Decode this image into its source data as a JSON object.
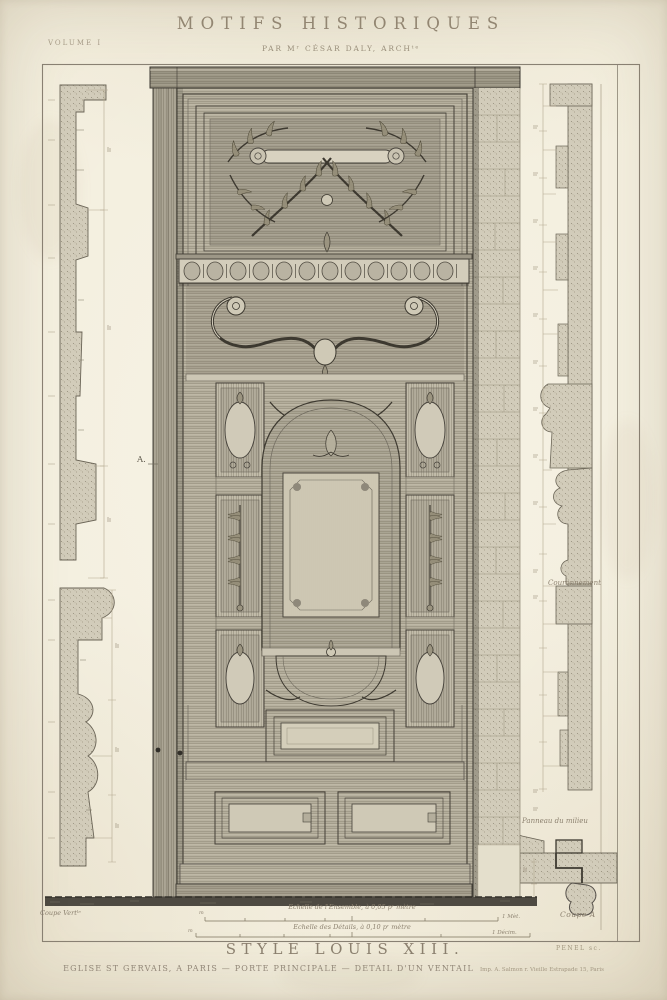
{
  "colors": {
    "paper": "#f3eedd",
    "ink": "#3e3a31",
    "faded_text": "#8d8270",
    "title_text": "#958976",
    "section_fill": "#d2ccba"
  },
  "header": {
    "volume": "VOLUME I",
    "title": "MOTIFS HISTORIQUES",
    "byline": "PAR Mʳ CÉSAR DALY, ARCHᵗᵉ"
  },
  "plate": {
    "marker_a": "A.",
    "label_couronnement": "Couronnement",
    "label_panneau": "Panneau du milieu",
    "label_coupe_verticale": "Coupe Vertˡᵉ",
    "label_coupe_a": "Coupe A",
    "scale_ensemble": "Echelle de l'Ensemble, à 0,05 pʳ mètre",
    "scale_ensemble_left_mark": "m",
    "scale_ensemble_mark": "1 Mèt.",
    "scale_details": "Echelle des Détails, à 0,10 pʳ mètre",
    "scale_details_left_mark": "m",
    "scale_details_mark": "1 Décim."
  },
  "footer": {
    "style_title": "STYLE LOUIS XIII.",
    "caption": "EGLISE ST GERVAIS, A PARIS — PORTE PRINCIPALE — DETAIL D'UN VENTAIL",
    "imprint": "Imp. A. Salmon r. Vieille Estrapade 15, Paris",
    "engraver": "PENEL sc."
  }
}
